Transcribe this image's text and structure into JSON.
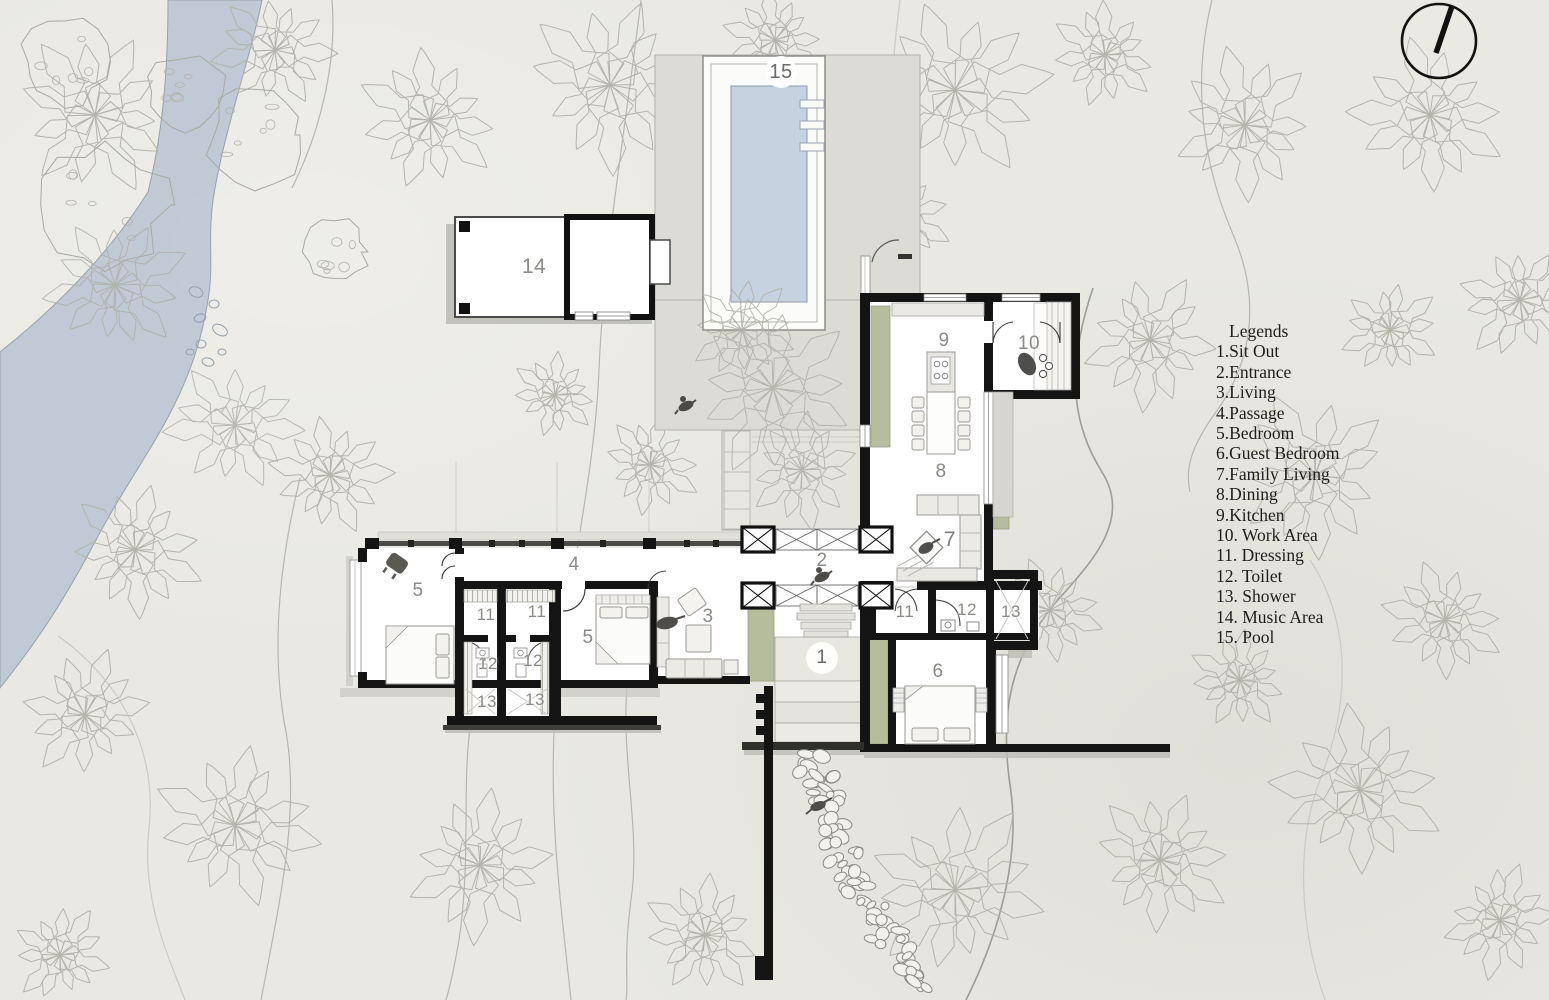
{
  "legend": {
    "title": "Legends",
    "items": [
      {
        "text": "1.Sit Out"
      },
      {
        "text": "2.Entrance"
      },
      {
        "text": "3.Living"
      },
      {
        "text": "4.Passage"
      },
      {
        "text": "5.Bedroom"
      },
      {
        "text": "6.Guest Bedroom"
      },
      {
        "text": "7.Family Living"
      },
      {
        "text": "8.Dining"
      },
      {
        "text": "9.Kitchen"
      },
      {
        "text": "10. Work Area"
      },
      {
        "text": "11. Dressing"
      },
      {
        "text": "12. Toilet"
      },
      {
        "text": "13. Shower"
      },
      {
        "text": "14. Music Area"
      },
      {
        "text": "15. Pool"
      }
    ]
  },
  "room_numbers": {
    "sit_out": "1",
    "entrance": "2",
    "living": "3",
    "passage": "4",
    "bedroom": "5",
    "guest_bedroom": "6",
    "family_living": "7",
    "dining": "8",
    "kitchen": "9",
    "work_area": "10",
    "dressing": "11",
    "toilet": "12",
    "shower": "13",
    "music_area": "14",
    "pool": "15"
  },
  "colors": {
    "paper": "#e9e8e2",
    "water": "#bcc6d3",
    "pool_water": "#c7d2e0",
    "deck": "#dcdbd6",
    "court": "#e4e3de",
    "wall": "#141414",
    "planter": "#b5bd9c",
    "label": "#8a8a86",
    "legend_text": "#1d1d1d"
  }
}
